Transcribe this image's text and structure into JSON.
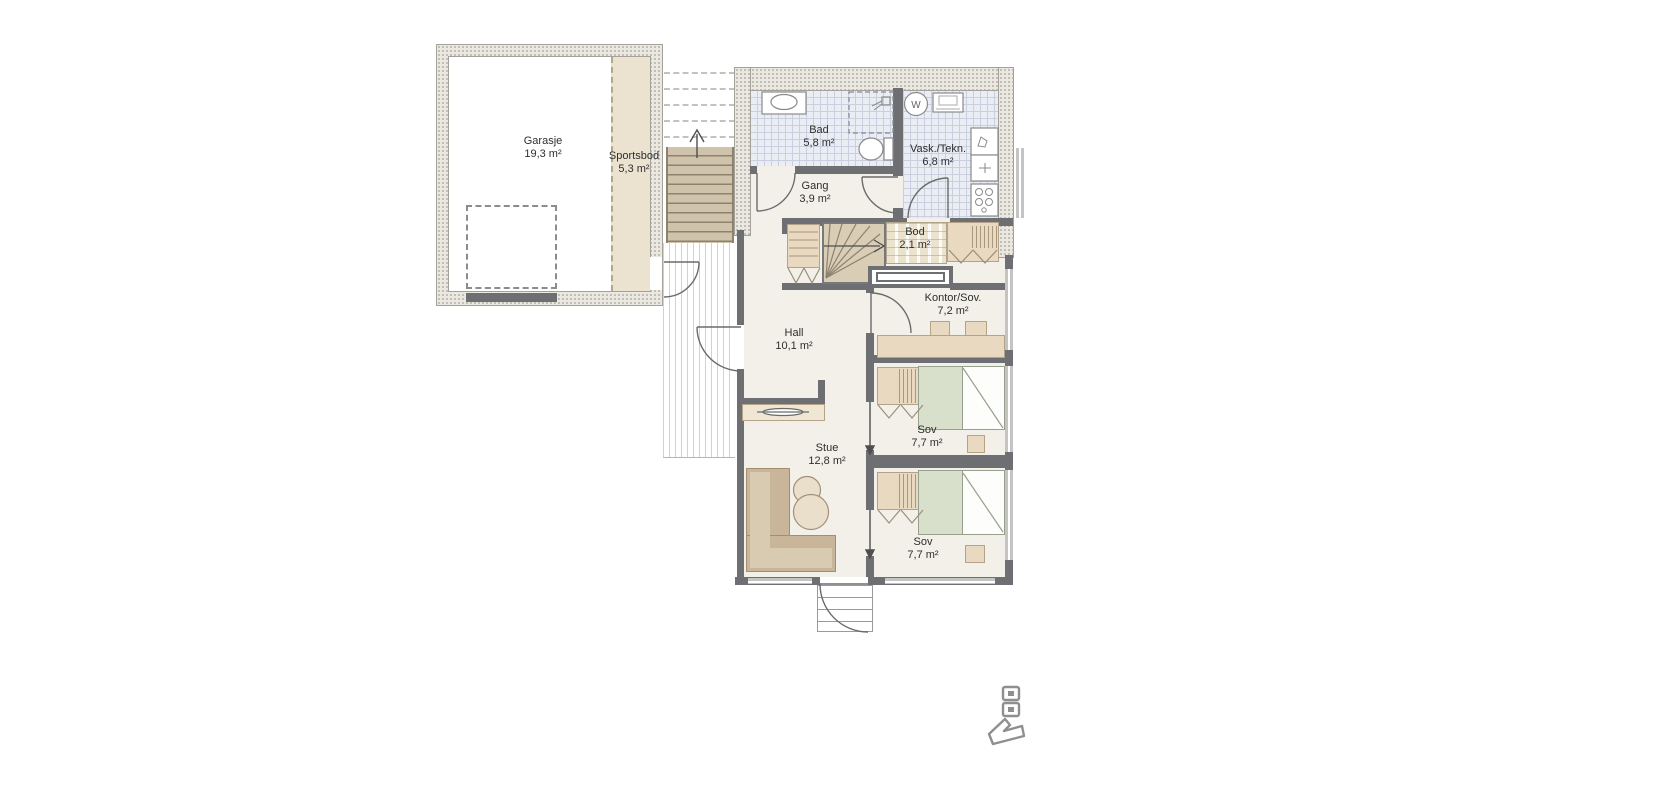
{
  "plan": {
    "title": "floor-plan",
    "rooms": [
      {
        "name": "Garasje",
        "area": "19,3 m²"
      },
      {
        "name": "Sportsbod",
        "area": "5,3 m²"
      },
      {
        "name": "Bad",
        "area": "5,8 m²"
      },
      {
        "name": "Vask./Tekn.",
        "area": "6,8 m²"
      },
      {
        "name": "Gang",
        "area": "3,9 m²"
      },
      {
        "name": "Bod",
        "area": "2,1 m²"
      },
      {
        "name": "Kontor/Sov.",
        "area": "7,2 m²"
      },
      {
        "name": "Hall",
        "area": "10,1 m²"
      },
      {
        "name": "Stue",
        "area": "12,8 m²"
      },
      {
        "name": "Sov",
        "area": "7,7 m²"
      },
      {
        "name": "Sov",
        "area": "7,7 m²"
      }
    ],
    "fixtures": {
      "washing_machine_label": "W"
    },
    "colors": {
      "wall_dark": "#6e6f72",
      "wall_textured": "#eae8e1",
      "tile_floor": "#eaedf4",
      "interior_floor": "#f2f0e9",
      "wood_tan": "#e9d9c0",
      "stair_tan": "#d9cdb5",
      "bed_green": "#d8dfcb",
      "sofa_brown": "#c9b69a",
      "logo_grey": "#8f8f8f"
    }
  }
}
